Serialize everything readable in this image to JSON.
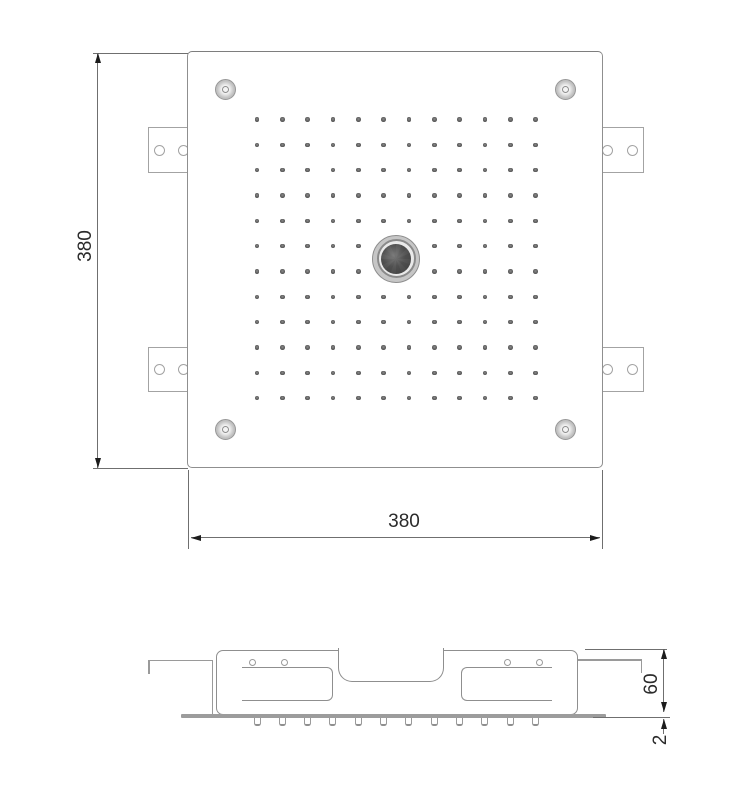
{
  "drawing": {
    "type": "technical-drawing",
    "subject": "square-ceiling-shower-head",
    "views": {
      "top": {
        "height_label": "380",
        "width_label": "380"
      },
      "section": {
        "height_label": "60",
        "plate_label": "2"
      }
    },
    "nozzle_grid": {
      "rows": 12,
      "cols": 12,
      "knob_rows": 2,
      "knob_cols": 2
    },
    "counts": {
      "corner_screws": 4,
      "mounting_brackets": 4,
      "bracket_holes": 8,
      "section_nozzles": 12
    },
    "colors": {
      "background": "#ffffff",
      "outline": "#8f8f8f",
      "bracket_line": "#a3a3a3",
      "dim_line": "#6f6f6f",
      "arrow": "#1c1c1c",
      "text": "#2b2b2b",
      "dot": "#5e5e5e",
      "plate": "#9c9c9c",
      "knob_outer": "#c6c6c6",
      "knob_ring": "#8a8a8a",
      "knob_core": "#555555"
    }
  }
}
